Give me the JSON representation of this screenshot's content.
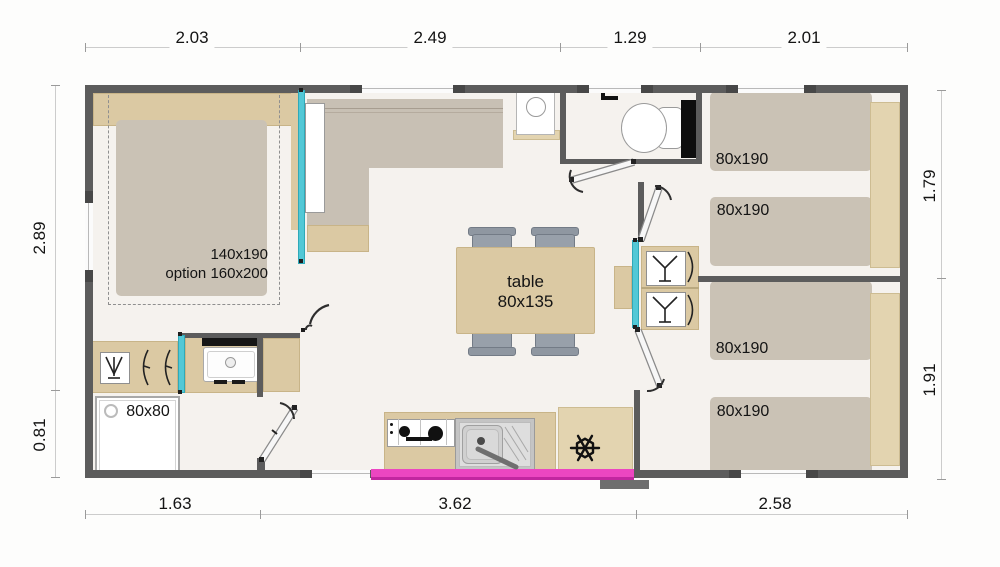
{
  "dims": {
    "top": [
      "2.03",
      "2.49",
      "1.29",
      "2.01"
    ],
    "bottom": [
      "1.63",
      "3.62",
      "2.58"
    ],
    "left": [
      "2.89",
      "0.81"
    ],
    "right": [
      "1.79",
      "1.91"
    ]
  },
  "labels": {
    "master_bed_size": "140x190",
    "master_bed_option": "option 160x200",
    "shower_size": "80x80",
    "table_name": "table",
    "table_size": "80x135",
    "bed_sizes": [
      "80x190",
      "80x190",
      "80x190",
      "80x190"
    ]
  },
  "colors": {
    "wall": "#5c5c5c",
    "wood": "#dbc9a3",
    "upholstery": "#c8c0b4",
    "glazing_accent": "#52c8d6",
    "entry_bay_accent": "#ec46c1",
    "chair": "#8f97a1",
    "floor": "#f5f2ee",
    "fixture_black": "#111111"
  }
}
